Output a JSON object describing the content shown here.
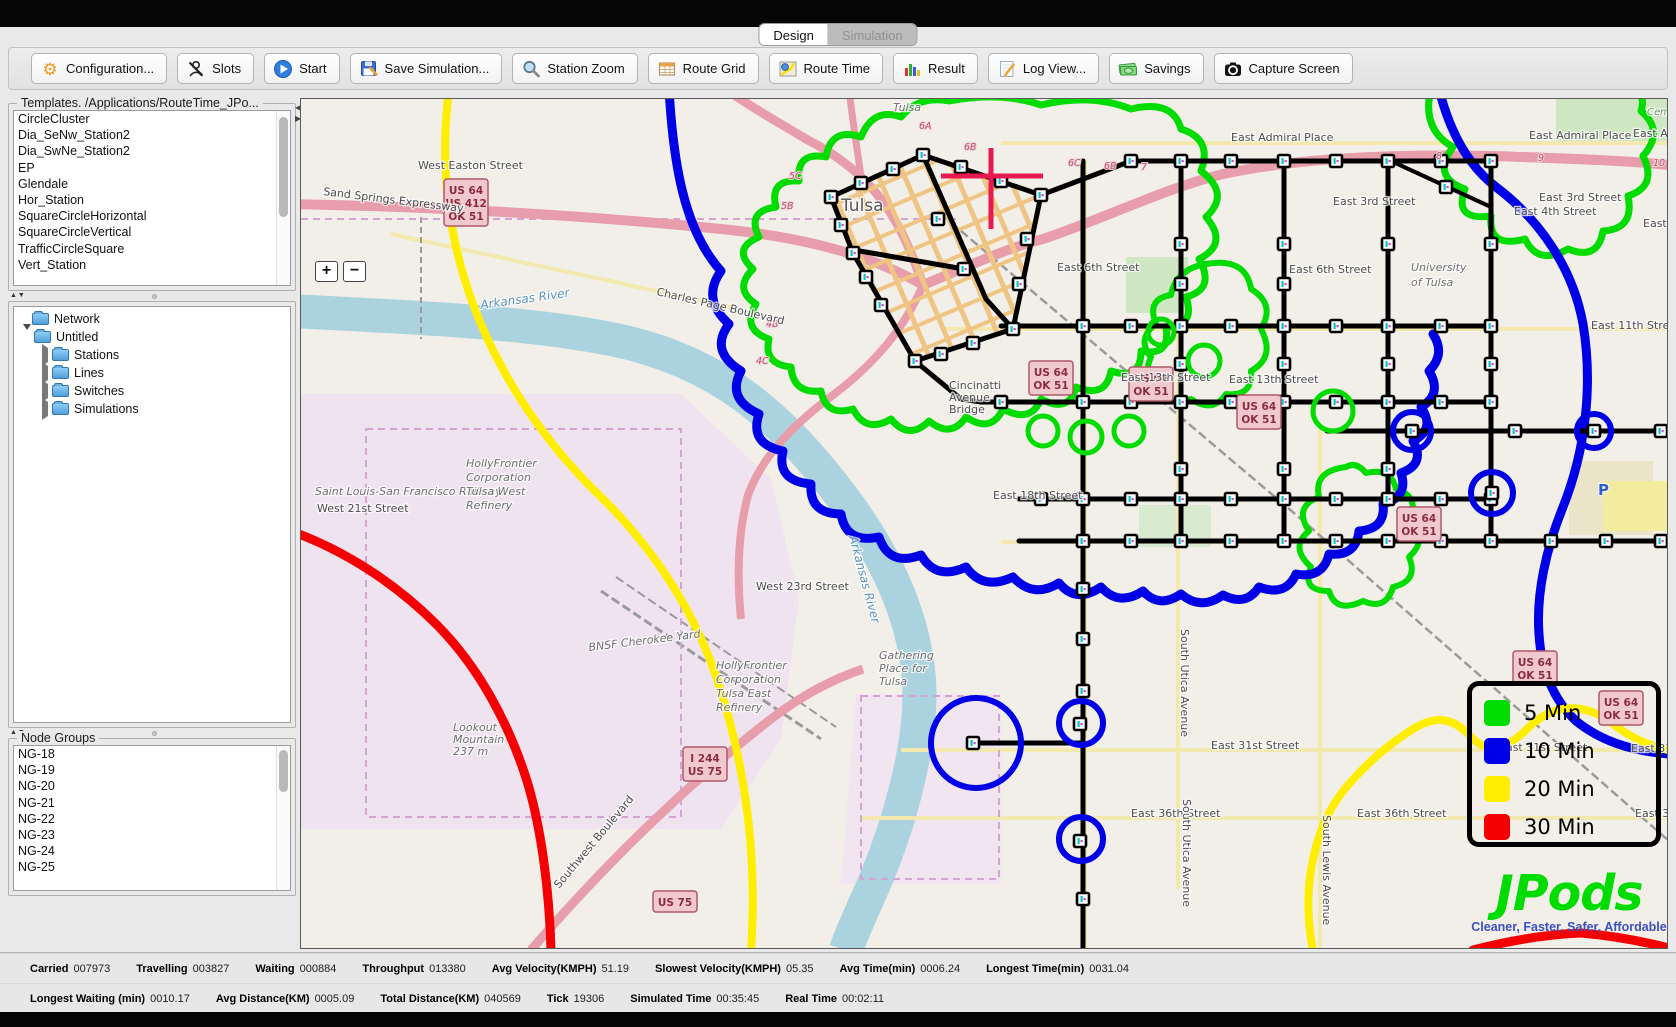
{
  "window": {
    "tabs": [
      {
        "label": "Design",
        "active": true
      },
      {
        "label": "Simulation",
        "active": false
      }
    ]
  },
  "toolbar": {
    "buttons": [
      {
        "label": "Configuration...",
        "icon": "gear-icon"
      },
      {
        "label": "Slots",
        "icon": "slots-icon"
      },
      {
        "label": "Start",
        "icon": "play-icon"
      },
      {
        "label": "Save Simulation...",
        "icon": "save-icon"
      },
      {
        "label": "Station Zoom",
        "icon": "magnifier-icon"
      },
      {
        "label": "Route Grid",
        "icon": "grid-icon"
      },
      {
        "label": "Route Time",
        "icon": "route-time-icon"
      },
      {
        "label": "Result",
        "icon": "bar-chart-icon"
      },
      {
        "label": "Log View...",
        "icon": "log-icon"
      },
      {
        "label": "Savings",
        "icon": "money-icon"
      },
      {
        "label": "Capture Screen",
        "icon": "camera-icon"
      }
    ]
  },
  "sidebar": {
    "templates": {
      "title": "Templates. /Applications/RouteTime_JPo...",
      "items": [
        "CircleCluster",
        "Dia_SeNw_Station2",
        "Dia_SwNe_Station2",
        "EP",
        "Glendale",
        "Hor_Station",
        "SquareCircleHorizontal",
        "SquareCircleVertical",
        "TrafficCircleSquare",
        "Vert_Station"
      ]
    },
    "network_tree": {
      "root": "Network",
      "children": [
        {
          "label": "Untitled",
          "expanded": true,
          "children": [
            {
              "label": "Stations"
            },
            {
              "label": "Lines"
            },
            {
              "label": "Switches"
            },
            {
              "label": "Simulations"
            }
          ]
        }
      ]
    },
    "node_groups": {
      "title": "Node Groups",
      "items": [
        "NG-18",
        "NG-19",
        "NG-20",
        "NG-21",
        "NG-22",
        "NG-23",
        "NG-24",
        "NG-25"
      ]
    }
  },
  "map": {
    "zoom_in": "+",
    "zoom_out": "−",
    "legend": {
      "items": [
        {
          "label": "5 Min",
          "color": "#00dc00"
        },
        {
          "label": "10 Min",
          "color": "#0000e6"
        },
        {
          "label": "20 Min",
          "color": "#ffee00"
        },
        {
          "label": "30 Min",
          "color": "#f50000"
        }
      ]
    },
    "logo": {
      "title": "JPods",
      "tagline": "Cleaner, Faster, Safer, Affordable"
    },
    "labels": [
      {
        "t": "West Easton Street",
        "x": 117,
        "y": 70
      },
      {
        "t": "Sand Springs Expressway",
        "x": 22,
        "y": 96,
        "r": 7
      },
      {
        "t": "Charles Page Boulevard",
        "x": 355,
        "y": 196,
        "r": 13
      },
      {
        "t": "Tulsa",
        "x": 592,
        "y": 12,
        "c": "place"
      },
      {
        "t": "Tulsa",
        "x": 540,
        "y": 112,
        "c": "big"
      },
      {
        "t": "East Admiral Place",
        "x": 930,
        "y": 42
      },
      {
        "t": "East Admiral Place",
        "x": 1228,
        "y": 40
      },
      {
        "t": "East Admiral Place",
        "x": 1332,
        "y": 38
      },
      {
        "t": "East 3rd Street",
        "x": 1032,
        "y": 106
      },
      {
        "t": "East 3rd Street",
        "x": 1238,
        "y": 102
      },
      {
        "t": "East 4th Street",
        "x": 1213,
        "y": 116
      },
      {
        "t": "East 4th Place",
        "x": 1342,
        "y": 128
      },
      {
        "t": "East 6th Street",
        "x": 756,
        "y": 172
      },
      {
        "t": "East 6th Street",
        "x": 988,
        "y": 174
      },
      {
        "t": "East 11th Street",
        "x": 1290,
        "y": 230
      },
      {
        "t": "East 13th Street",
        "x": 820,
        "y": 282
      },
      {
        "t": "East 13th Street",
        "x": 928,
        "y": 284
      },
      {
        "t": "East 18th Street",
        "x": 692,
        "y": 400
      },
      {
        "t": "West 23rd Street",
        "x": 455,
        "y": 491
      },
      {
        "t": "West 21st Street",
        "x": 16,
        "y": 413
      },
      {
        "t": "Saint Louis-San Francisco Railway",
        "x": 14,
        "y": 396,
        "c": "place",
        "s": 9
      },
      {
        "t": "East 31st Street",
        "x": 910,
        "y": 650
      },
      {
        "t": "East 31st Street",
        "x": 1198,
        "y": 652
      },
      {
        "t": "East 31st Street",
        "x": 1330,
        "y": 653
      },
      {
        "t": "East 36th Street",
        "x": 830,
        "y": 718
      },
      {
        "t": "East 36th Street",
        "x": 1056,
        "y": 718
      },
      {
        "t": "East 36th Street",
        "x": 1334,
        "y": 718
      },
      {
        "t": "Southwest Boulevard",
        "x": 258,
        "y": 790,
        "r": -50
      },
      {
        "t": "South Utica Avenue",
        "x": 880,
        "y": 530,
        "r": 90
      },
      {
        "t": "South Utica Avenue",
        "x": 882,
        "y": 700,
        "r": 90
      },
      {
        "t": "South Lewis Avenue",
        "x": 1022,
        "y": 716,
        "r": 90
      },
      {
        "t": "Cemetery",
        "x": 1346,
        "y": 16,
        "c": "green"
      },
      {
        "t": "P",
        "x": 1297,
        "y": 396,
        "c": "blue"
      },
      {
        "lines": [
          "Cincinatti",
          "Avenue",
          "Bridge"
        ],
        "x": 648,
        "y": 290,
        "s": 10
      },
      {
        "lines": [
          "University",
          "of Tulsa"
        ],
        "x": 1110,
        "y": 172,
        "c": "place",
        "s": 13
      },
      {
        "lines": [
          "HollyFrontier",
          "Corporation",
          "Tulsa West",
          "Refinery"
        ],
        "x": 165,
        "y": 368,
        "c": "place",
        "s": 12
      },
      {
        "lines": [
          "HollyFrontier",
          "Corporation",
          "Tulsa East",
          "Refinery"
        ],
        "x": 415,
        "y": 570,
        "c": "place",
        "s": 12
      },
      {
        "t": "BNSF Cherokee Yard",
        "x": 288,
        "y": 552,
        "c": "place",
        "r": -7
      },
      {
        "lines": [
          "Gathering",
          "Place for",
          "Tulsa"
        ],
        "x": 578,
        "y": 560,
        "c": "place",
        "s": 11
      },
      {
        "lines": [
          "Lookout",
          "Mountain",
          "237 m"
        ],
        "x": 152,
        "y": 632,
        "c": "place",
        "s": 10
      },
      {
        "t": "Arkansas River",
        "x": 180,
        "y": 210,
        "c": "water",
        "r": -8
      },
      {
        "t": "Arkansas River",
        "x": 548,
        "y": 438,
        "c": "water",
        "r": 75
      }
    ],
    "shields": [
      {
        "lines": [
          "US 64",
          "US 412",
          "OK 51"
        ],
        "x": 143,
        "y": 80
      },
      {
        "lines": [
          "US 64",
          "OK 51"
        ],
        "x": 728,
        "y": 262
      },
      {
        "lines": [
          "US 64",
          "OK 51"
        ],
        "x": 828,
        "y": 268
      },
      {
        "lines": [
          "US 64",
          "OK 51"
        ],
        "x": 936,
        "y": 296
      },
      {
        "lines": [
          "US 64",
          "OK 51"
        ],
        "x": 1096,
        "y": 408
      },
      {
        "lines": [
          "US 64",
          "OK 51"
        ],
        "x": 1212,
        "y": 552
      },
      {
        "lines": [
          "US 64",
          "OK 51"
        ],
        "x": 1298,
        "y": 592
      },
      {
        "lines": [
          "I 244",
          "US 75"
        ],
        "x": 382,
        "y": 648
      },
      {
        "lines": [
          "US 75"
        ],
        "x": 352,
        "y": 792
      }
    ],
    "road_markers": [
      {
        "t": "6A",
        "x": 618,
        "y": 30
      },
      {
        "t": "6B",
        "x": 663,
        "y": 51
      },
      {
        "t": "6C",
        "x": 767,
        "y": 67
      },
      {
        "t": "6B",
        "x": 803,
        "y": 70
      },
      {
        "t": "7",
        "x": 840,
        "y": 71
      },
      {
        "t": "8",
        "x": 1135,
        "y": 60
      },
      {
        "t": "9",
        "x": 1237,
        "y": 62
      },
      {
        "t": "10",
        "x": 1352,
        "y": 67
      },
      {
        "t": "5C",
        "x": 488,
        "y": 80
      },
      {
        "t": "5B",
        "x": 480,
        "y": 110
      },
      {
        "t": "4B",
        "x": 465,
        "y": 228
      },
      {
        "t": "4C",
        "x": 455,
        "y": 265
      }
    ]
  },
  "status_bar": {
    "row1": [
      {
        "label": "Carried",
        "value": "007973"
      },
      {
        "label": "Travelling",
        "value": "003827"
      },
      {
        "label": "Waiting",
        "value": "000884"
      },
      {
        "label": "Throughput",
        "value": "013380"
      },
      {
        "label": "Avg Velocity(KMPH)",
        "value": "51.19"
      },
      {
        "label": "Slowest Velocity(KMPH)",
        "value": "05.35"
      },
      {
        "label": "Avg Time(min)",
        "value": "0006.24"
      },
      {
        "label": "Longest Time(min)",
        "value": "0031.04"
      }
    ],
    "row2": [
      {
        "label": "Longest Waiting (min)",
        "value": "0010.17"
      },
      {
        "label": "Avg Distance(KM)",
        "value": "0005.09"
      },
      {
        "label": "Total Distance(KM)",
        "value": "040569"
      },
      {
        "label": "Tick",
        "value": "19306"
      },
      {
        "label": "Simulated Time",
        "value": "00:35:45"
      },
      {
        "label": "Real Time",
        "value": "00:02:11"
      }
    ]
  }
}
